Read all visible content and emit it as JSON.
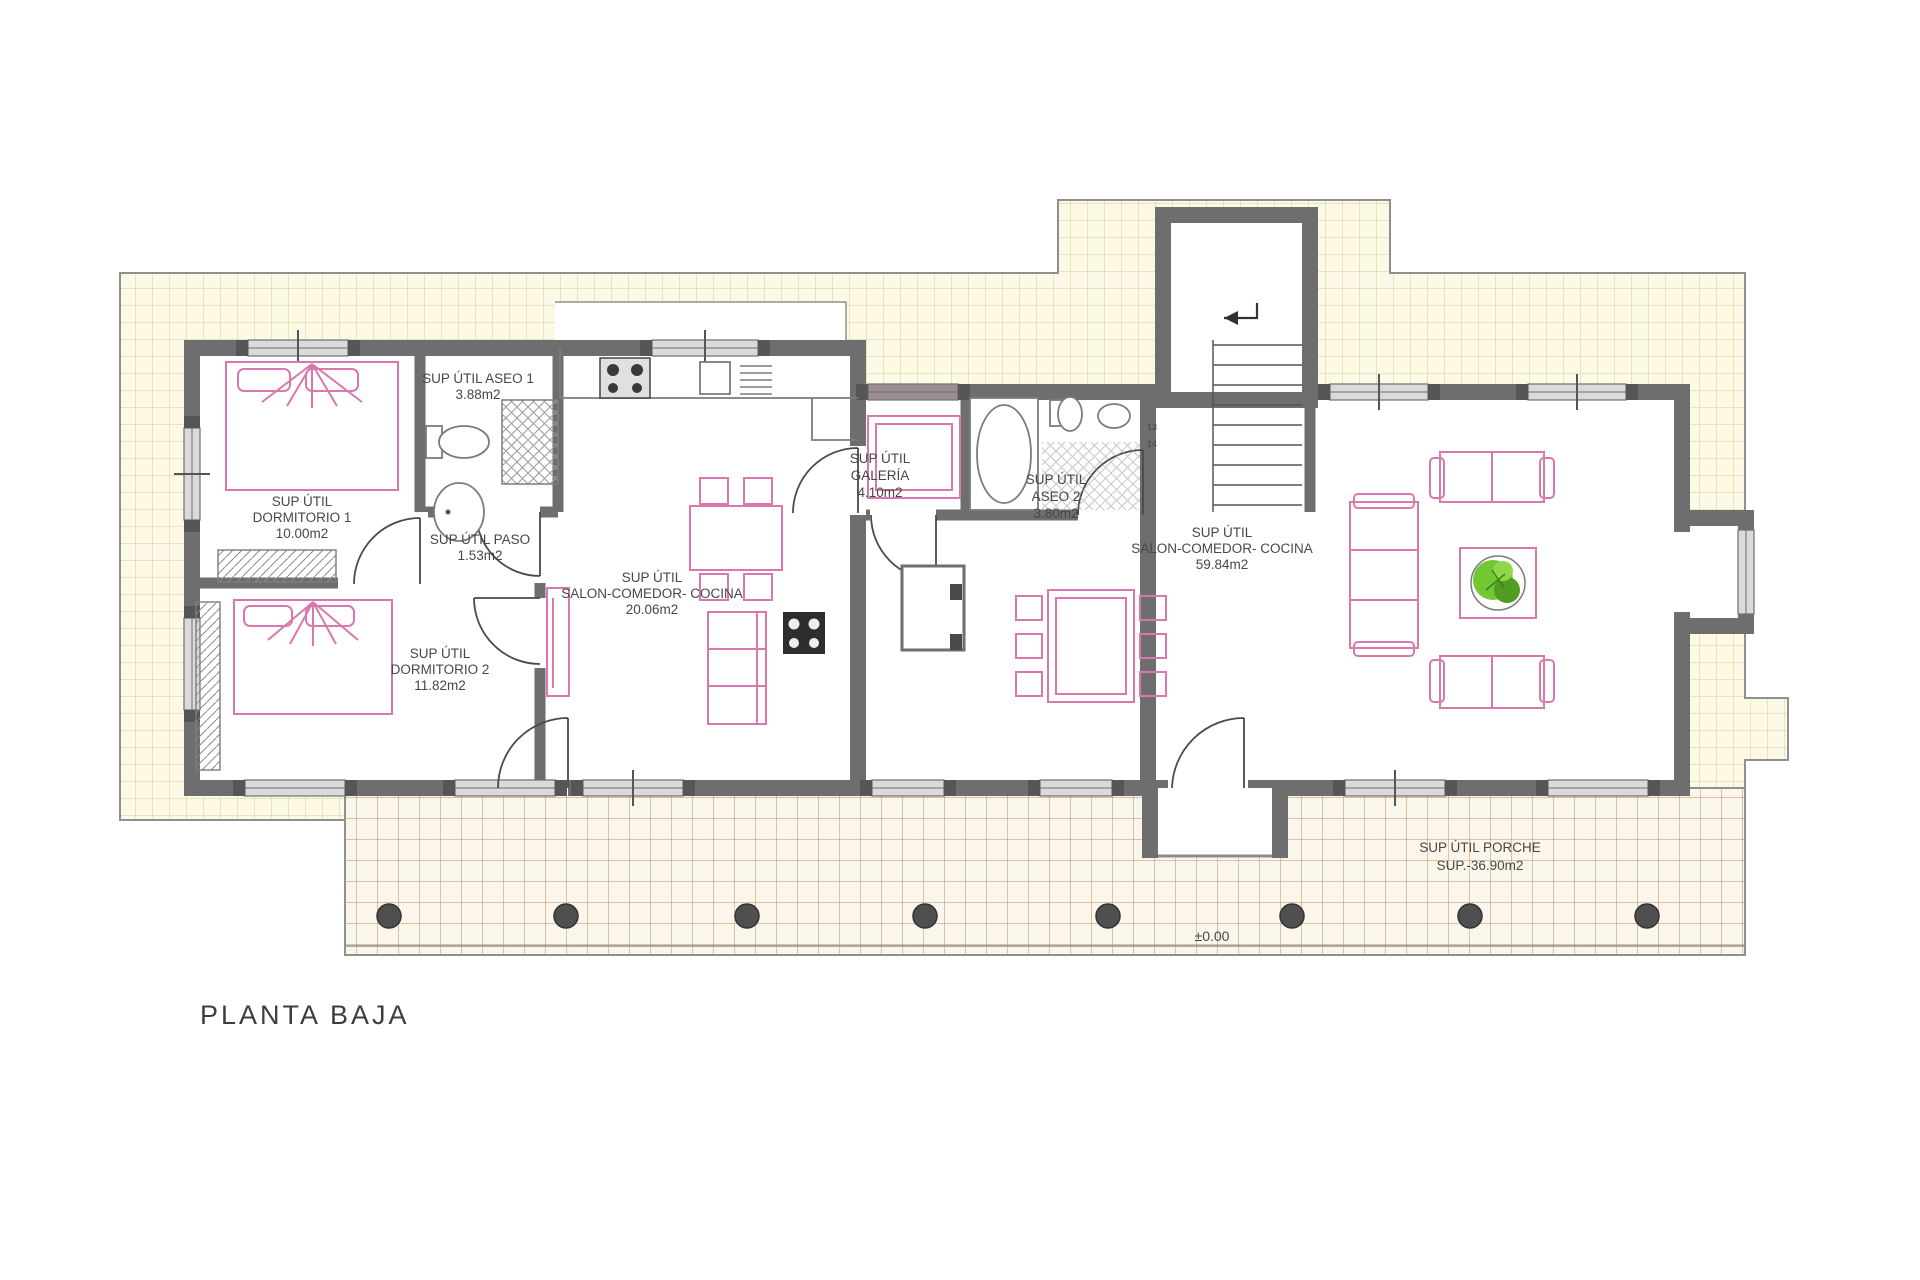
{
  "title": "PLANTA BAJA",
  "level_mark": "±0.00",
  "rooms": {
    "dormitorio1": {
      "l1": "SUP ÚTIL",
      "l2": "DORMITORIO 1",
      "l3": "10.00m2"
    },
    "aseo1": {
      "l1": "SUP ÚTIL ASEO 1",
      "l2": "3.88m2"
    },
    "paso": {
      "l1": "SUP ÚTIL PASO",
      "l2": "1.53m2"
    },
    "dormitorio2": {
      "l1": "SUP ÚTIL",
      "l2": "DORMITORIO 2",
      "l3": "11.82m2"
    },
    "salon_izq": {
      "l1": "SUP ÚTIL",
      "l2": "SALON-COMEDOR- COCINA",
      "l3": "20.06m2"
    },
    "galeria": {
      "l1": "SUP ÚTIL",
      "l2": "GALERÍA",
      "l3": "4.10m2"
    },
    "aseo2": {
      "l1": "SUP ÚTIL",
      "l2": "ASEO 2",
      "l3": "3.80m2"
    },
    "salon_der": {
      "l1": "SUP ÚTIL",
      "l2": "SALON-COMEDOR- COCINA",
      "l3": "59.84m2"
    },
    "porche": {
      "l1": "SUP ÚTIL PORCHE",
      "l2": "SUP.-36.90m2"
    }
  },
  "stairs": {
    "tread_a": "13",
    "tread_b": "14"
  },
  "colors": {
    "terrace_fill": "#fcf9e6",
    "terrace_grid": "#d9d08e",
    "porch_fill": "#fbf6ec",
    "porch_grid": "#c08a60",
    "wall": "#6e6e6e",
    "furniture_pink": "#d878ae",
    "plant_green": "#5cb82a",
    "text": "#474747"
  }
}
